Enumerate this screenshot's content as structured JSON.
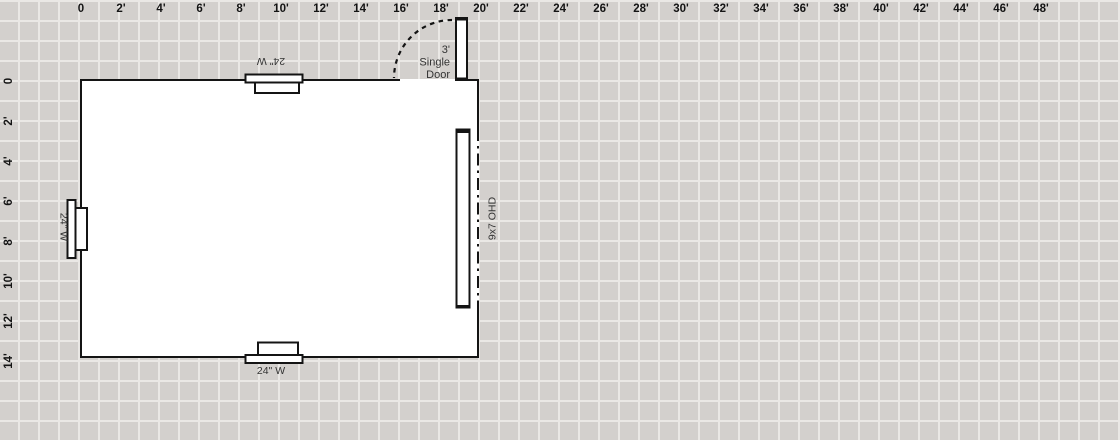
{
  "colors": {
    "canvas_bg": "#d3d0cd",
    "grid_line": "#eae8e5",
    "wall": "#141414",
    "fixture_fill": "#ffffff",
    "label_text": "#333333",
    "ruler_text": "#141414"
  },
  "rulers": {
    "top_labels": [
      "0",
      "2'",
      "4'",
      "6'",
      "8'",
      "10'",
      "12'",
      "14'",
      "16'",
      "18'",
      "20'",
      "22'",
      "24'",
      "26'",
      "28'",
      "30'",
      "32'",
      "34'",
      "36'",
      "38'",
      "40'",
      "42'",
      "44'",
      "46'",
      "48'"
    ],
    "left_labels": [
      "0",
      "2'",
      "4'",
      "6'",
      "8'",
      "10'",
      "12'",
      "14'"
    ]
  },
  "plan": {
    "windows": {
      "top": {
        "label": "24\" W"
      },
      "left": {
        "label": "24\" W"
      },
      "bottom": {
        "label": "24\" W"
      }
    },
    "entry_door": {
      "lines": [
        "3'",
        "Single",
        "Door"
      ]
    },
    "overhead_door": {
      "label": "9x7 OHD"
    }
  }
}
